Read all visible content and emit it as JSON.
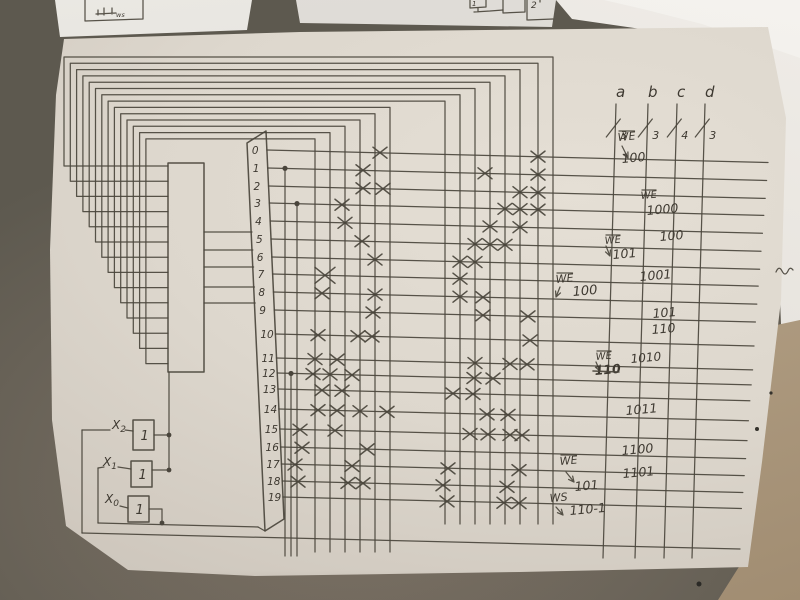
{
  "scene_kind": "photo of hand-drawn microprogram decoder matrix schematic on paper",
  "palette": {
    "pencil": "#4a453c",
    "ink_text": "#3e3931",
    "paper": "#d9d3c9",
    "desk": "#6c655a",
    "side_paper": "#edeae4",
    "beige_paper": "#b5a287",
    "faint_pencil": "#80838a"
  },
  "top_sketches": {
    "left_box_label": "ws",
    "mid_box_label_1": "1",
    "mid_box_label_2": "2"
  },
  "drawing": {
    "rows": [
      {
        "label": "0",
        "y": 150
      },
      {
        "label": "1",
        "y": 168
      },
      {
        "label": "2",
        "y": 186
      },
      {
        "label": "3",
        "y": 203
      },
      {
        "label": "4",
        "y": 221
      },
      {
        "label": "5",
        "y": 239
      },
      {
        "label": "6",
        "y": 257
      },
      {
        "label": "7",
        "y": 274
      },
      {
        "label": "8",
        "y": 292
      },
      {
        "label": "9",
        "y": 310
      },
      {
        "label": "10",
        "y": 334
      },
      {
        "label": "11",
        "y": 358
      },
      {
        "label": "12",
        "y": 373
      },
      {
        "label": "13",
        "y": 389
      },
      {
        "label": "14",
        "y": 409
      },
      {
        "label": "15",
        "y": 429
      },
      {
        "label": "16",
        "y": 447
      },
      {
        "label": "17",
        "y": 464
      },
      {
        "label": "18",
        "y": 481
      },
      {
        "label": "19",
        "y": 497
      }
    ],
    "row_slope": 0.025,
    "row_end_x": 768,
    "columns_bus_fed": [
      553,
      538,
      520,
      505,
      490,
      475,
      460,
      445,
      390,
      375,
      360,
      345,
      330,
      315
    ],
    "bus": {
      "y0": 57,
      "dy": 6.3,
      "x0": 64,
      "dx": 6.3,
      "stub_y0": 166,
      "stub_dy": 15.2,
      "bottom_right": 524,
      "bottom_left": 552
    },
    "feedback_columns": [
      {
        "x": 285,
        "row": 1
      },
      {
        "x": 297,
        "row": 3
      },
      {
        "x": 291,
        "row": 12
      }
    ],
    "register": {
      "x": 168,
      "y": 163,
      "w": 36,
      "h": 209
    },
    "decoder_trapezoid": "247,143 266,131 284,519 265,531",
    "connector_ys": [
      232,
      250,
      267,
      287,
      303
    ],
    "crosses": [
      [
        380,
        0
      ],
      [
        538,
        0
      ],
      [
        363,
        1
      ],
      [
        485,
        1
      ],
      [
        538,
        1
      ],
      [
        363,
        2
      ],
      [
        383,
        2
      ],
      [
        520,
        2
      ],
      [
        538,
        2
      ],
      [
        342,
        3
      ],
      [
        505,
        3
      ],
      [
        520,
        3
      ],
      [
        538,
        3
      ],
      [
        345,
        4
      ],
      [
        490,
        4
      ],
      [
        520,
        4
      ],
      [
        362,
        5
      ],
      [
        475,
        5
      ],
      [
        490,
        5
      ],
      [
        505,
        5
      ],
      [
        375,
        6
      ],
      [
        460,
        6
      ],
      [
        475,
        6
      ],
      [
        325,
        7
      ],
      [
        460,
        7
      ],
      [
        322,
        8
      ],
      [
        375,
        8
      ],
      [
        460,
        8
      ],
      [
        483,
        8
      ],
      [
        373,
        9
      ],
      [
        483,
        9
      ],
      [
        528,
        9
      ],
      [
        318,
        10
      ],
      [
        358,
        10
      ],
      [
        372,
        10
      ],
      [
        530,
        10
      ],
      [
        315,
        11
      ],
      [
        337,
        11
      ],
      [
        475,
        11
      ],
      [
        510,
        11
      ],
      [
        527,
        11
      ],
      [
        313,
        12
      ],
      [
        330,
        12
      ],
      [
        352,
        12
      ],
      [
        474,
        12
      ],
      [
        493,
        12
      ],
      [
        322,
        13
      ],
      [
        342,
        13
      ],
      [
        453,
        13
      ],
      [
        473,
        13
      ],
      [
        318,
        14
      ],
      [
        337,
        14
      ],
      [
        360,
        14
      ],
      [
        387,
        14
      ],
      [
        487,
        14
      ],
      [
        508,
        14
      ],
      [
        300,
        15
      ],
      [
        335,
        15
      ],
      [
        470,
        15
      ],
      [
        488,
        15
      ],
      [
        510,
        15
      ],
      [
        522,
        15
      ],
      [
        302,
        16
      ],
      [
        367,
        16
      ],
      [
        295,
        17
      ],
      [
        352,
        17
      ],
      [
        448,
        17
      ],
      [
        519,
        17
      ],
      [
        298,
        18
      ],
      [
        348,
        18
      ],
      [
        363,
        18
      ],
      [
        443,
        18
      ],
      [
        507,
        18
      ],
      [
        447,
        19
      ],
      [
        504,
        19
      ],
      [
        519,
        19
      ]
    ],
    "big_cross": [
      325,
      7
    ],
    "outputs": {
      "y_top": 104,
      "y_bottom": 558,
      "lean": 13,
      "label_y": 97,
      "slash_y": 128,
      "lines": [
        {
          "label": "a",
          "width": "3",
          "x_top": 616
        },
        {
          "label": "b",
          "width": "3",
          "x_top": 648
        },
        {
          "label": "c",
          "width": "4",
          "x_top": 677
        },
        {
          "label": "d",
          "width": "3",
          "x_top": 705
        }
      ]
    },
    "annotations": [
      {
        "text": "WE",
        "x": 618,
        "y": 141,
        "size": 11,
        "ol": true,
        "arrow": [
          622,
          146,
          628,
          158
        ]
      },
      {
        "text": "100",
        "x": 622,
        "y": 163,
        "size": 12.5
      },
      {
        "text": "WE",
        "x": 641,
        "y": 199,
        "size": 10,
        "ol": true
      },
      {
        "text": "1000",
        "x": 647,
        "y": 215,
        "size": 12.5
      },
      {
        "text": "100",
        "x": 660,
        "y": 241,
        "size": 12.5
      },
      {
        "text": "WE",
        "x": 605,
        "y": 244,
        "size": 10,
        "ol": true,
        "arrow": [
          606,
          246,
          610,
          256
        ]
      },
      {
        "text": "101",
        "x": 613,
        "y": 259,
        "size": 12.5
      },
      {
        "text": "1001",
        "x": 640,
        "y": 281,
        "size": 12.5
      },
      {
        "text": "WE",
        "x": 556,
        "y": 283,
        "size": 11,
        "ol": true,
        "arrow": [
          560,
          287,
          556,
          297
        ]
      },
      {
        "text": "100",
        "x": 573,
        "y": 296,
        "size": 13
      },
      {
        "text": "101",
        "x": 653,
        "y": 318,
        "size": 12.5
      },
      {
        "text": "110",
        "x": 652,
        "y": 334,
        "size": 12.5
      },
      {
        "text": "WE",
        "x": 596,
        "y": 360,
        "size": 10,
        "ol": true,
        "arrow": [
          596,
          362,
          600,
          371
        ]
      },
      {
        "text": "1010",
        "x": 631,
        "y": 363,
        "size": 12
      },
      {
        "text": "110",
        "x": 595,
        "y": 375,
        "size": 12.5,
        "strike": true
      },
      {
        "text": "1011",
        "x": 626,
        "y": 415,
        "size": 12.5
      },
      {
        "text": "1100",
        "x": 622,
        "y": 455,
        "size": 12.5
      },
      {
        "text": "WE",
        "x": 560,
        "y": 465,
        "size": 11,
        "ol": true,
        "arrow": [
          566,
          472,
          574,
          482
        ]
      },
      {
        "text": "1101",
        "x": 623,
        "y": 478,
        "size": 12.5
      },
      {
        "text": "101",
        "x": 575,
        "y": 491,
        "size": 12.5
      },
      {
        "text": "WS",
        "x": 550,
        "y": 502,
        "size": 11,
        "arrow": [
          556,
          507,
          563,
          515
        ]
      },
      {
        "text": "110-1",
        "x": 570,
        "y": 515,
        "size": 12.5
      }
    ],
    "inputs": {
      "gate_glyph": "1",
      "boxes": [
        {
          "label": "X",
          "sub": "2",
          "x": 133,
          "y": 420,
          "w": 21,
          "h": 30,
          "lx": 112,
          "ly": 429
        },
        {
          "label": "X",
          "sub": "1",
          "x": 131,
          "y": 461,
          "w": 21,
          "h": 26,
          "lx": 103,
          "ly": 466
        },
        {
          "label": "X",
          "sub": "0",
          "x": 128,
          "y": 496,
          "w": 21,
          "h": 26,
          "lx": 105,
          "ly": 503
        }
      ],
      "wires": [
        "82,430 110,430",
        "82,430 82,533",
        "82,533 740,549",
        "98,468 104,467",
        "98,468 98,523",
        "98,523 258,527",
        "258,527 265,531",
        "125,430 133,431",
        "118,467 131,469",
        "120,506 128,508",
        "154,435 169,435",
        "152,470 169,470",
        "169,372 169,470",
        "149,509 162,509 162,523"
      ],
      "dots": [
        [
          169,
          435
        ],
        [
          169,
          470
        ],
        [
          162,
          523
        ]
      ]
    }
  }
}
